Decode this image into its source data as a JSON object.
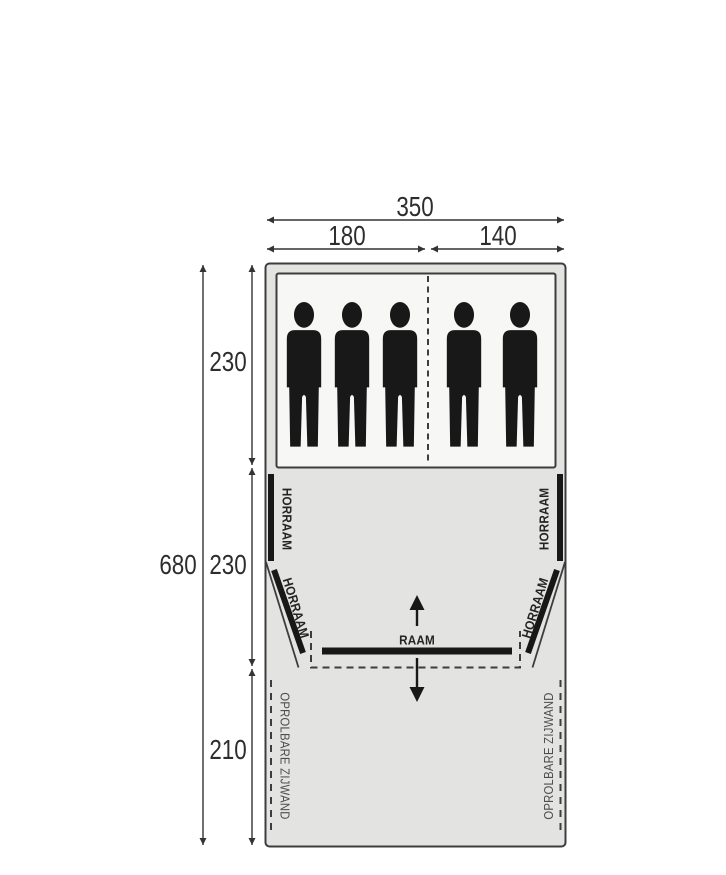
{
  "diagram": {
    "type": "tent-floorplan",
    "colors": {
      "background": "#ffffff",
      "tent_fill": "#e3e3e1",
      "sleeping_fill": "#f7f7f5",
      "outline": "#3d3d3d",
      "window_bar": "#181818",
      "dimension_text": "#2d2d2d",
      "sidewall_text": "#4f4f4f"
    },
    "dimensions": {
      "total_width": "350",
      "sleeping_left_width": "180",
      "sleeping_right_width": "140",
      "total_depth": "680",
      "sleeping_depth": "230",
      "living_depth": "230",
      "canopy_depth": "210"
    },
    "labels": {
      "screen_window": "HORRAAM",
      "front_window": "RAAM",
      "rollup_sidewall": "OPROLBARE ZIJWAND"
    },
    "sleeping_area": {
      "persons_left": 3,
      "persons_right": 2
    }
  }
}
